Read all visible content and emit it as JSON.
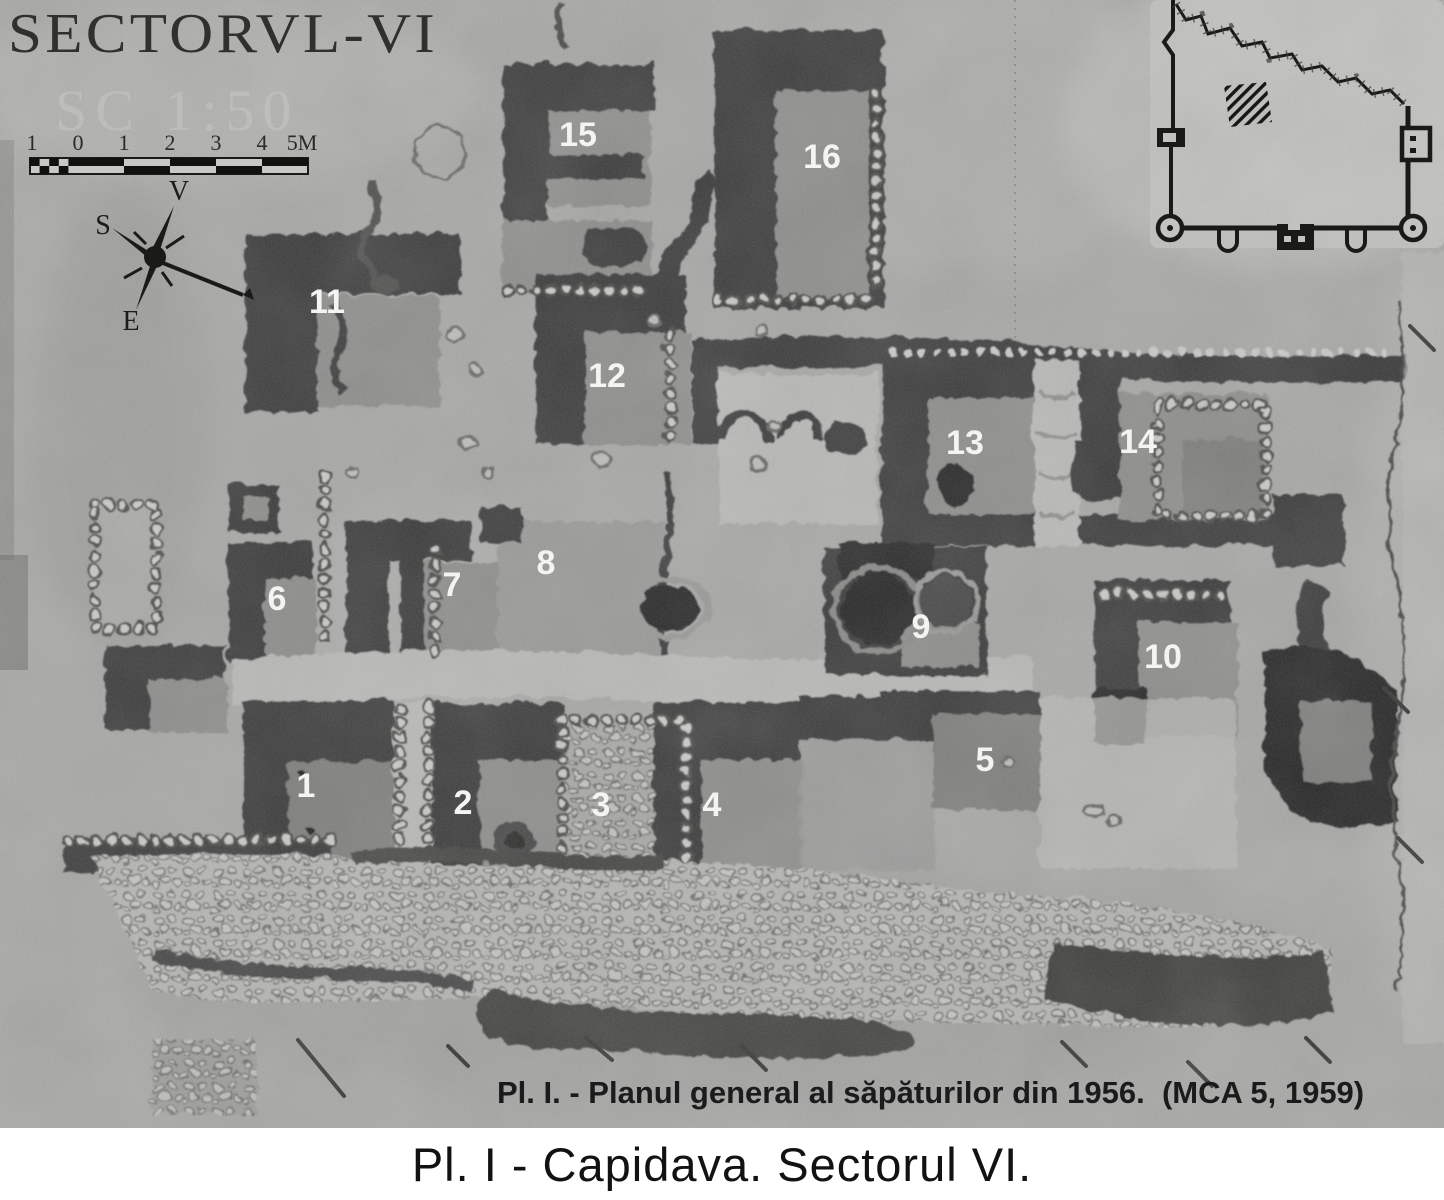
{
  "plan": {
    "title": "SECTORVL-VI",
    "watermark": "SC 1:50",
    "scale_bar": {
      "labels": [
        "1",
        "0",
        "1",
        "2",
        "3",
        "4",
        "5M"
      ]
    },
    "compass": {
      "v": "V",
      "s": "S",
      "e": "E"
    },
    "markers": [
      "1",
      "2",
      "3",
      "4",
      "5",
      "6",
      "7",
      "8",
      "9",
      "10",
      "11",
      "12",
      "13",
      "14",
      "15",
      "16"
    ],
    "caption": "Pl. I. - Planul general al săpăturilor din 1956.  (MCA 5, 1959)"
  },
  "footer": {
    "caption": "Pl. I - Capidava. Sectorul VI."
  },
  "colors": {
    "paper": "#a8a8a6",
    "trench_dark": "#3e3e3c",
    "room_mid": "#8e8e8c",
    "light_zone": "#b9b9b7",
    "ink": "#1a1a18",
    "marker_label": "#f4f4f2",
    "caption_text": "#1b1b1b"
  }
}
